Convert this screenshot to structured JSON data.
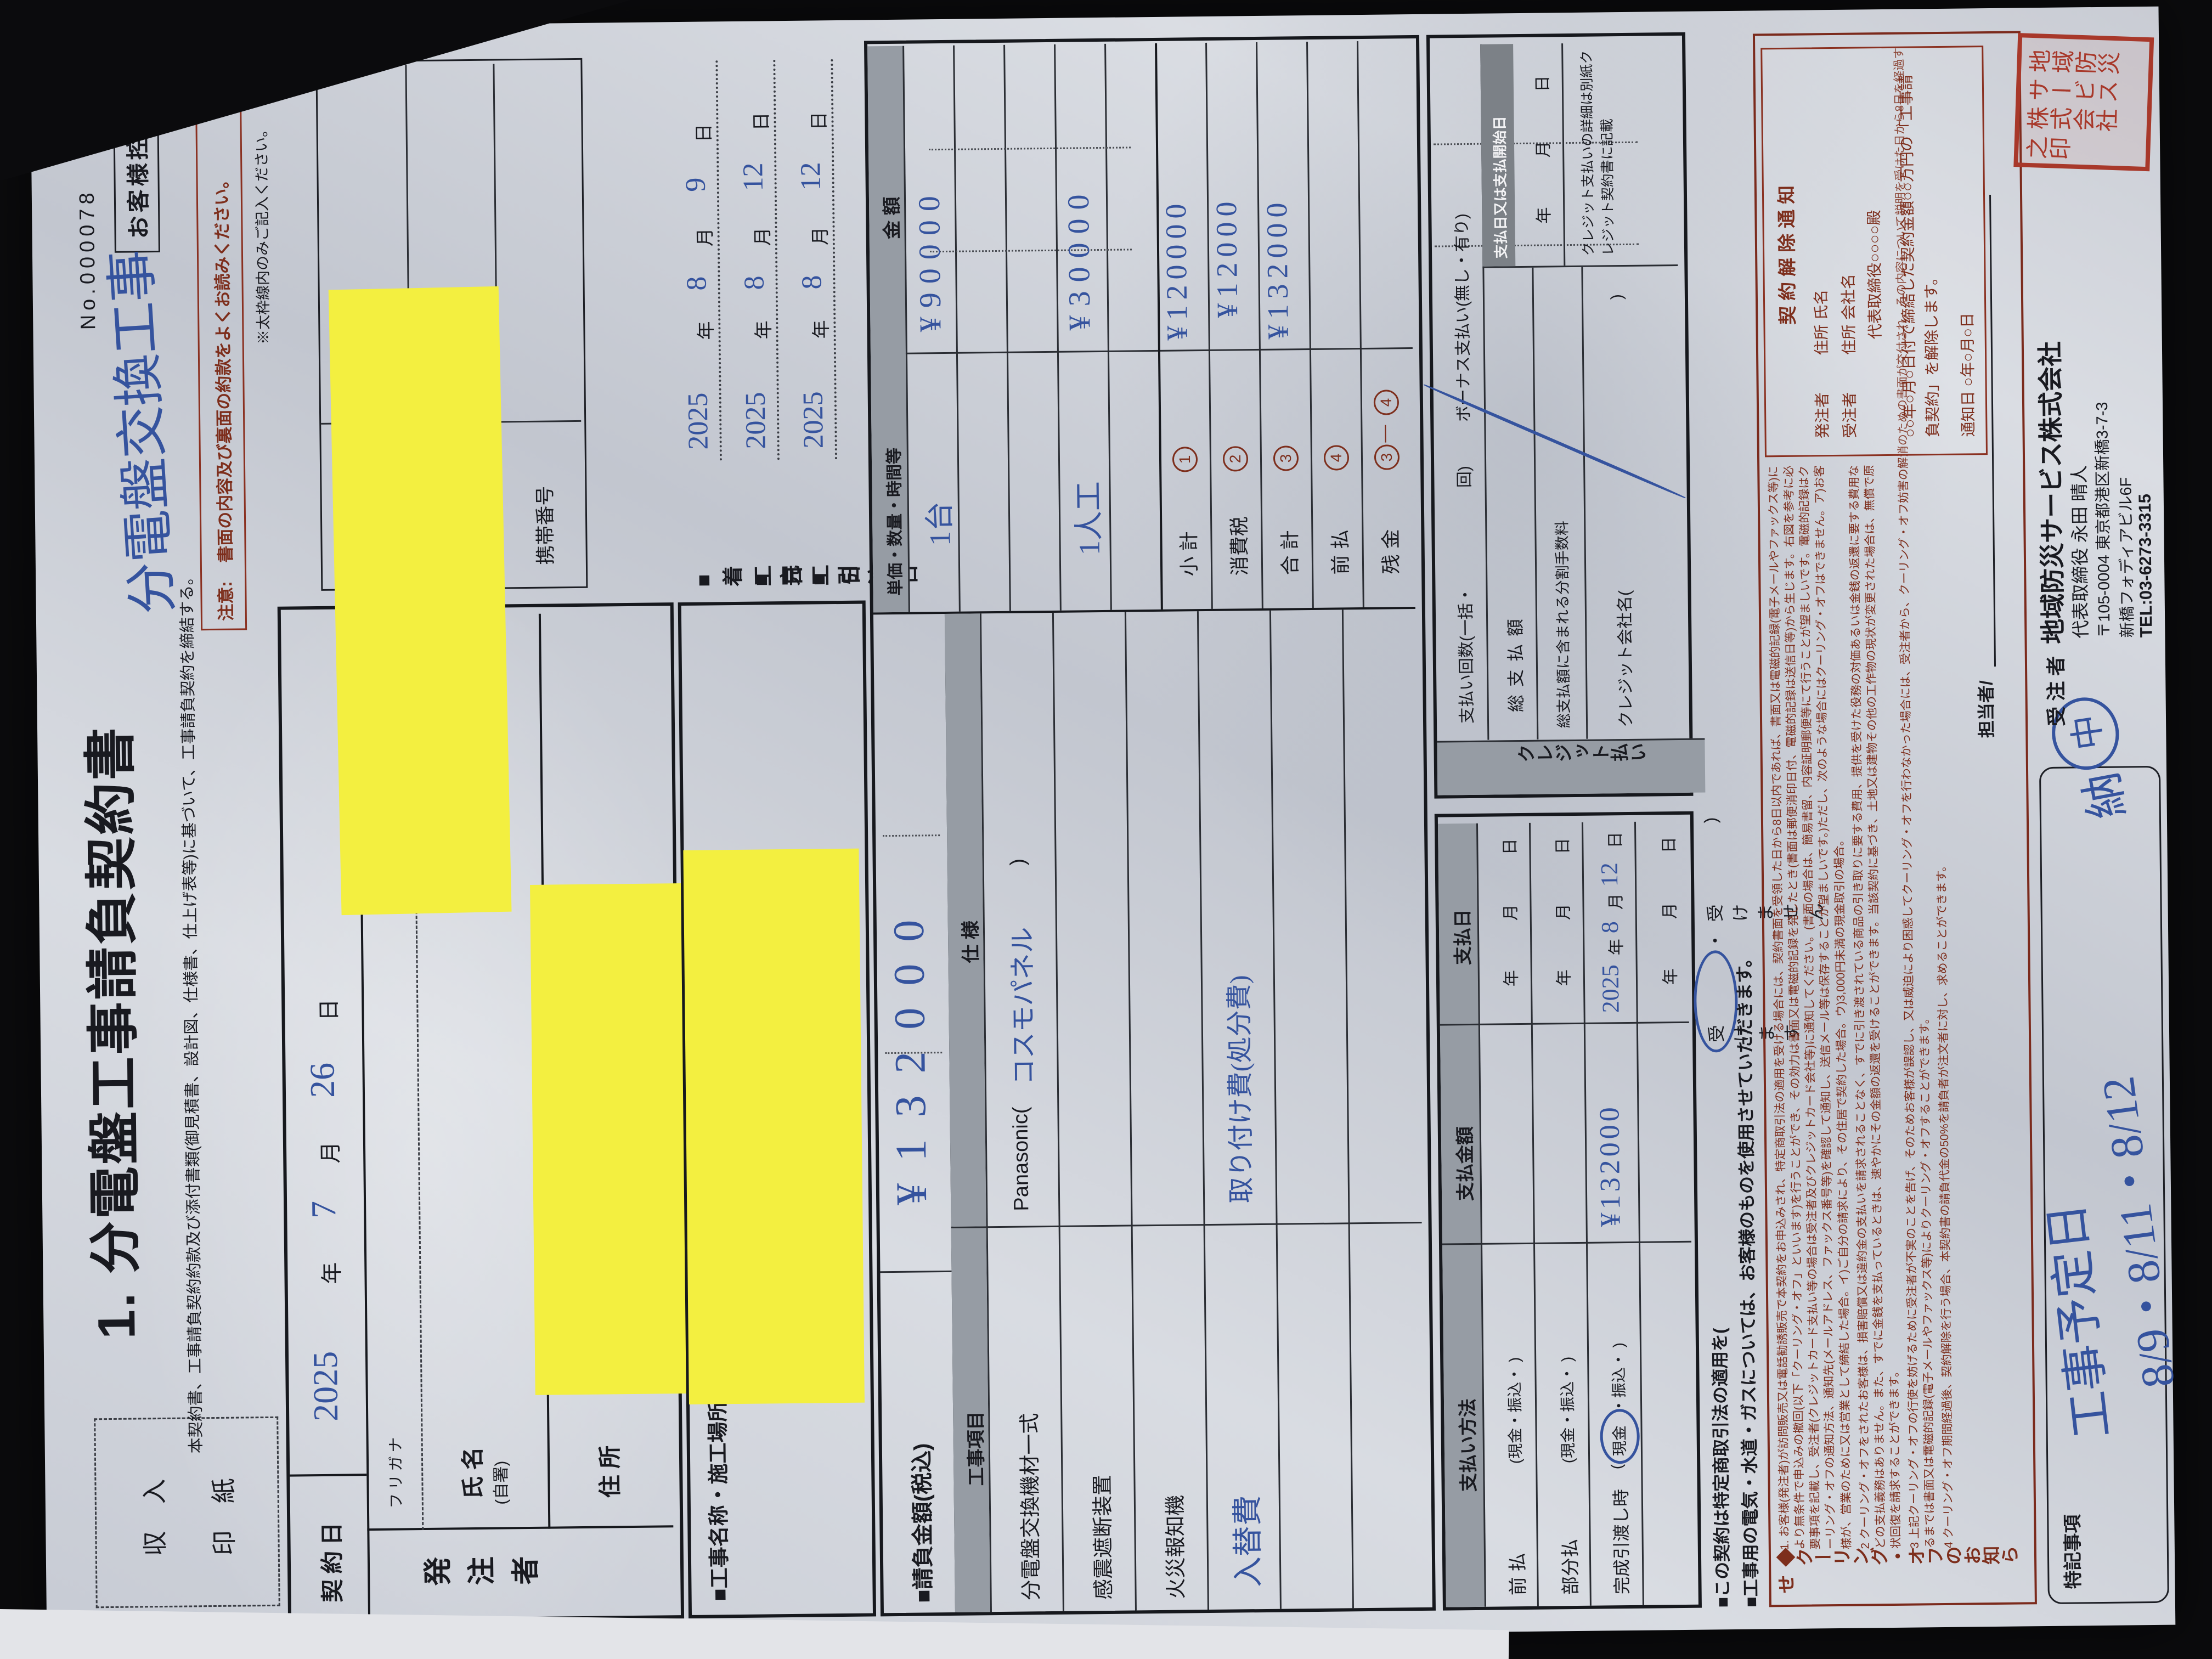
{
  "header": {
    "no": "No.000078",
    "copy": "お客様控",
    "title": "1. 分電盤工事請負契約書",
    "subtitle": "本契約書、工事請負契約約款及び添付書類(御見積書、設計図、仕様書、仕上げ表等)に基づいて、工事請負契約を締結する。",
    "notice": "書面の内容及び裏面の約款をよくお読みください。",
    "notice_prefix": "注意:",
    "frame_note": "※太枠線内のみご記入ください。",
    "stamp_line1": "収  入",
    "stamp_line2": "印  紙",
    "hand_work_name": "分電盤交換工事"
  },
  "units": {
    "year": "年",
    "month": "月",
    "day": "日"
  },
  "contract_date": {
    "label": "契約日",
    "y": "2025",
    "m": "7",
    "d": "26"
  },
  "orderer": {
    "group": "発注者",
    "furigana": "フリガナ",
    "name1": "氏 名",
    "name2": "(自署)",
    "address": "住 所",
    "postal_mark": "〒",
    "seal": "印",
    "birth": "生年月日",
    "phone": "電話番号",
    "mobile": "携帯番号"
  },
  "site": {
    "label": "■工事名称・施工場所"
  },
  "dates": [
    {
      "label": "■着工日",
      "y": "2025",
      "m": "8",
      "d": "9"
    },
    {
      "label": "■完工日",
      "y": "2025",
      "m": "8",
      "d": "12"
    },
    {
      "label": "■引渡日",
      "y": "2025",
      "m": "8",
      "d": "12"
    }
  ],
  "table": {
    "amount_label": "■請負金額(税込)",
    "amount_value": "¥132000",
    "col_item": "工事項目",
    "col_spec": "仕  様",
    "col_qty": "単価・数量・時間等",
    "col_amount": "金  額",
    "items": [
      {
        "name": "分電盤交換機材一式",
        "spec_pre": "Panasonic(",
        "spec_hand": "コスモパネル",
        "spec_post": ")"
      },
      {
        "name": "感震遮断装置"
      },
      {
        "name": "火災報知機"
      },
      {
        "name_hand": "入替費",
        "spec_hand": "取り付け費(処分費)"
      }
    ],
    "vals": {
      "qty1": "1台",
      "amt1": "¥90000",
      "qty4": "1人工",
      "amt4": "¥30000"
    },
    "sums": [
      {
        "label": "小 計",
        "m1": "1",
        "value": "¥120000"
      },
      {
        "label": "消費税",
        "m1": "2",
        "value": "¥12000"
      },
      {
        "label": "合 計",
        "m1": "3",
        "value": "¥132000"
      },
      {
        "label": "前 払",
        "m1": "4",
        "value": ""
      },
      {
        "label": "残 金",
        "m1": "3",
        "dash": "―",
        "m2": "4",
        "value": ""
      }
    ]
  },
  "payment": {
    "method_h": "支払い方法",
    "amount_h": "支払金額",
    "date_h": "支払日",
    "row1": "前  払",
    "row2": "部分払",
    "row3": "完成引渡し時",
    "paren_full": "(現金・振込・  )",
    "paren_open": "(",
    "cash": "現金",
    "paren_rest": "・振込・  )",
    "pay_amount": "¥132000",
    "pay_y": "2025",
    "pay_m": "8",
    "pay_d": "12",
    "credit_label": "クレジット払い",
    "installments": "支払い回数(一括・",
    "installments_end": "回)",
    "bonus": "ボーナス支払い(無し・有り)",
    "total": "総支払額",
    "fee": "総支払額に含まれる分割手数料",
    "credit_co": "クレジット会社名(",
    "credit_co_end": ")",
    "start_h": "支払日又は支払開始日",
    "credit_note": "クレジット支払いの詳細は別紙クレジット契約書に記載",
    "law_pre": "■この契約は特定商取引法の適用を(",
    "law_accept": "受けます",
    "law_mid": "・",
    "law_decline": "受けません",
    "law_end": ")",
    "utility": "■工事用の電気・水道・ガスについては、お客様のものを使用させていただきます。"
  },
  "cooling": {
    "side_label": "◆クーリング・オフのお知らせ",
    "clause1": "1. お客様(発注者)が訪問販売又は電話勧誘販売で本契約をお申込みされ、特定商取引法の適用を受ける場合には、契約書面を受領した日から8日以内であれば、書面又は電磁的記録(電子メールやファックス等)により無条件で申込みの撤回(以下「クーリング・オフ」といいます)を行うことができ、その効力は書面又は電磁的記録を発したとき(書面は郵便消印日付、電磁的記録は送信日等)から生じます。右図を参考に必要事項を記載し、受注者(クレジットカード支払い等の場合は受注者及びクレジットカード会社等)に通知してください。(書面の場合は、簡易書留、内容証明郵便等にて行うことが望ましいです。電磁的記録はクーリング・オフの通知方法、通知先(メールアドレス、ファックス番号等)を確認して通知し、送信メール等は保存することが望ましいです。)ただし、次のような場合にはクーリング・オフはできません。ア)お客様が、営業のために又は営業として締結した場合。イ)ご自分の請求により、その住居で契約した場合。ウ)3,000円未満の現金取引の場合。",
    "clause2": "2 クーリング・オフをされたお客様は、損害賠償又は違約金の支払いを請求されることなく、すでに引き渡されている商品の引き取りに要する費用、提供を受けた役務の対価あるいは金銭の返還に要する費用などの支払義務はありません。また、すでに金銭を支払っているときは、速やかにその金額の返還を受けることができます。当該契約に基づき、土地又は建物その他の工作物の現状が変更された場合は、無償で原状回復を請求することができます。",
    "clause3": "3 上記クーリング・オフの行使を妨げるために受注者が不実のことを告げ、そのためお客様が誤認し、又は威迫により困惑してクーリング・オフを行わなかった場合には、受注者から、クーリング・オフ妨害の解消のための書面が交付され、その内容について説明を受けた日から8日を経過するまでは書面又は電磁的記録(電子メールやファックス等)によりクーリング・オフすることができます。",
    "clause4": "4 クーリング・オフ期間経過後、契約解除を行う場合、本契約書の請負代金の50%を請負者が注文者に対し、求めることができます。",
    "notice_box": {
      "title": "契約解除通知",
      "line1a": "発注者",
      "line1b": "住所  氏名",
      "line2a": "受注者",
      "line2b": "住所  会社名",
      "line3": "代表取締役○○○○殿",
      "body": "○○年○月○日付で締結した契約金額○○万円の「工事請負契約」を解除します。",
      "date_line": "通知日 ○年○月○日"
    }
  },
  "bottom": {
    "tokki": "特記事項",
    "note1": "工事予定日",
    "note2": "8/9・8/11・8/12",
    "note3": "納",
    "note3_circle": "中",
    "juchusha": "受 注 者",
    "company": "地域防災サービス株式会社",
    "rep": "代表取締役  永田 晴人",
    "postal": "〒105-0004 東京都港区新橋3-7-3",
    "building": "新橋フォディアビル6F",
    "tel": "TEL:03-6273-3315",
    "tanto": "担当者/",
    "seal_c1": "地域防災",
    "seal_c2": "サービス",
    "seal_c3": "株式会社",
    "seal_c4": "之印"
  }
}
